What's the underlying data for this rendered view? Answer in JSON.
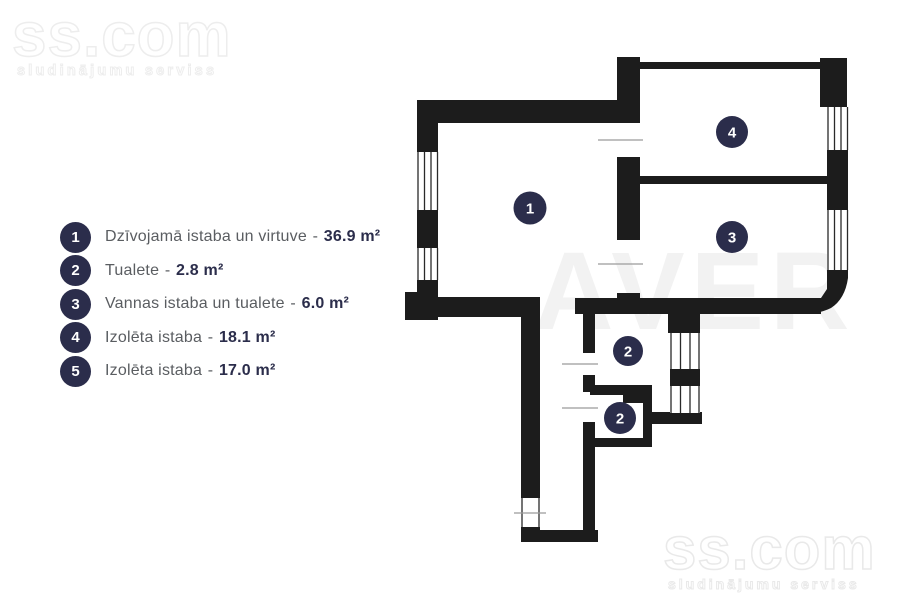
{
  "watermark": {
    "brand": "ss.com",
    "tagline": "sludinājumu serviss",
    "center_mark": "AVER"
  },
  "legend": {
    "separator": "-",
    "items": [
      {
        "num": "1",
        "label": "Dzīvojamā istaba un virtuve",
        "value": "36.9 m²"
      },
      {
        "num": "2",
        "label": "Tualete",
        "value": "2.8 m²"
      },
      {
        "num": "3",
        "label": "Vannas istaba un tualete",
        "value": "6.0 m²"
      },
      {
        "num": "4",
        "label": "Izolēta istaba",
        "value": "18.1 m²"
      },
      {
        "num": "5",
        "label": "Izolēta istaba",
        "value": "17.0 m²"
      }
    ]
  },
  "floorplan": {
    "room_markers": [
      {
        "num": "1"
      },
      {
        "num": "4"
      },
      {
        "num": "3"
      },
      {
        "num": "2"
      },
      {
        "num": "2"
      }
    ]
  },
  "colors": {
    "wall": "#1c1c1c",
    "marker": "#2b2d4b",
    "legend_text": "#5a5d61",
    "legend_value": "#2b2d4b",
    "watermark": "#ededed"
  }
}
